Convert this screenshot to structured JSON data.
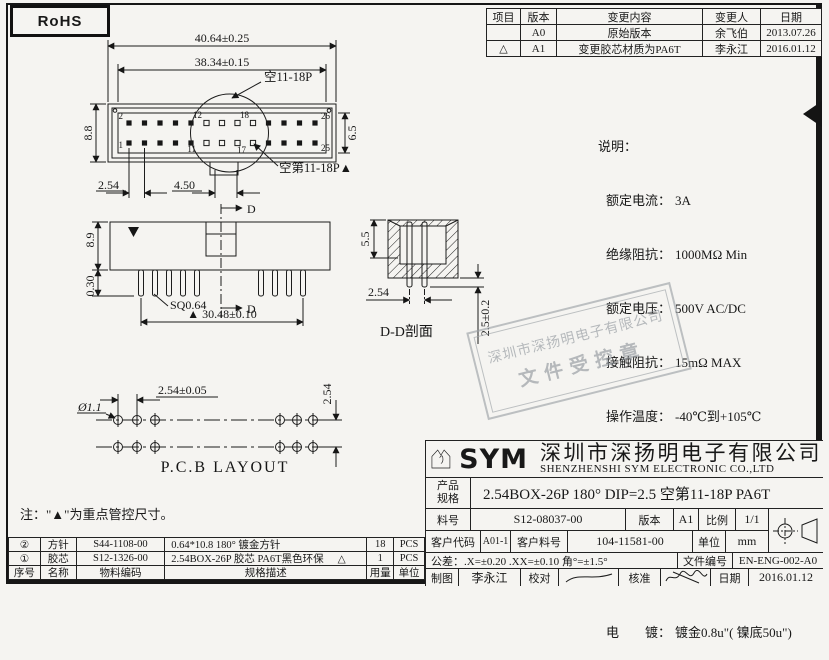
{
  "page": {
    "rohs_label": "RoHS"
  },
  "revision_table": {
    "headers": {
      "item": "项目",
      "version": "版本",
      "content": "变更内容",
      "person": "变更人",
      "date": "日期"
    },
    "rows": [
      {
        "marker": "",
        "version": "A0",
        "content": "原始版本",
        "person": "余飞伯",
        "date": "2013.07.26"
      },
      {
        "marker": "△",
        "version": "A1",
        "content": "变更胶芯材质为PA6T",
        "person": "李永江",
        "date": "2016.01.12"
      }
    ]
  },
  "specs": {
    "title": "说明：",
    "items": [
      {
        "label": "额定电流：",
        "value": "3A"
      },
      {
        "label": "绝缘阻抗：",
        "value": "1000MΩ Min"
      },
      {
        "label": "额定电压：",
        "value": "500V AC/DC"
      },
      {
        "label": "接触阻抗：",
        "value": "15mΩ MAX"
      },
      {
        "label": "操作温度：",
        "value": "-40℃到+105℃"
      },
      {
        "label": "接触材料：",
        "value": "黄铜"
      },
      {
        "label": "绝缘材料：",
        "value": "PA6T / BK"
      },
      {
        "label": "燃烧等级：",
        "value": "UL 94V-0"
      },
      {
        "label": "电　　镀：",
        "value": "镀金0.8u\"( 镍底50u\")"
      }
    ]
  },
  "top_view": {
    "dim_overall": "40.64±0.25",
    "dim_inner": "38.34±0.15",
    "dim_height_left": "8.8",
    "dim_height_right": "6.5",
    "dim_pitch": "2.54",
    "dim_gap": "4.50",
    "label_skip": "空11-18P",
    "label_skip2": "空第11-18P▲",
    "pin_2": "2",
    "pin_1": "1",
    "pin_12": "12",
    "pin_18": "18",
    "pin_11": "11",
    "pin_17": "17",
    "pin_26": "26",
    "pin_25": "25"
  },
  "front_view": {
    "dim_height": "8.9",
    "dim_pin_len": "0.30",
    "pin_label": "SQ0.64",
    "dim_span": "▲ 30.48±0.10",
    "section_label": "D"
  },
  "section_view": {
    "dim_depth": "5.5",
    "dim_pitch": "2.54",
    "dim_tail": "2.5±0.2",
    "title": "D-D剖面"
  },
  "pcb_layout": {
    "dim_pitch": "2.54±0.05",
    "dim_hole": "Ø1.1",
    "dim_row": "2.54",
    "title": "P.C.B LAYOUT"
  },
  "note": "注：\"▲\"为重点管控尺寸。",
  "stamp": {
    "line1": "深圳市深扬明电子有限公司",
    "line2": "文件受控章"
  },
  "bom": {
    "headers": {
      "no": "序号",
      "name": "名称",
      "code": "物料编码",
      "desc": "规格描述",
      "qty": "用量",
      "unit": "单位"
    },
    "rows": [
      {
        "no": "②",
        "name": "方针",
        "code": "S44-1108-00",
        "desc": "0.64*10.8 180° 镀金方针",
        "marker": "",
        "qty": "18",
        "unit": "PCS"
      },
      {
        "no": "①",
        "name": "胶芯",
        "code": "S12-1326-00",
        "desc": "2.54BOX-26P 胶芯 PA6T黑色环保",
        "marker": "△",
        "qty": "1",
        "unit": "PCS"
      }
    ]
  },
  "title_block": {
    "logo_text": "SYM",
    "company_cn": "深圳市深扬明电子有限公司",
    "company_en": "SHENZHENSHI SYM ELECTRONIC CO.,LTD",
    "product_label_1": "产品",
    "product_label_2": "规格",
    "product_value": "2.54BOX-26P  180° DIP=2.5 空第11-18P PA6T",
    "part_label": "料号",
    "part_value": "S12-08037-00",
    "version_label": "版本",
    "version_value": "A1",
    "scale_label": "比例",
    "scale_value": "1/1",
    "customer_code_label": "客户代码",
    "customer_code_value": "A01-1",
    "customer_part_label": "客户料号",
    "customer_part_value": "104-11581-00",
    "unit_label": "单位",
    "unit_value": "mm",
    "tolerance": "公差：.X=±0.20  .XX=±0.10  角°=±1.5°",
    "doc_no_label": "文件编号",
    "doc_no_value": "EN-ENG-002-A0",
    "draw_label": "制图",
    "draw_value": "李永江",
    "check_label": "校对",
    "approve_label": "核准",
    "date_label": "日期",
    "date_value": "2016.01.12"
  }
}
